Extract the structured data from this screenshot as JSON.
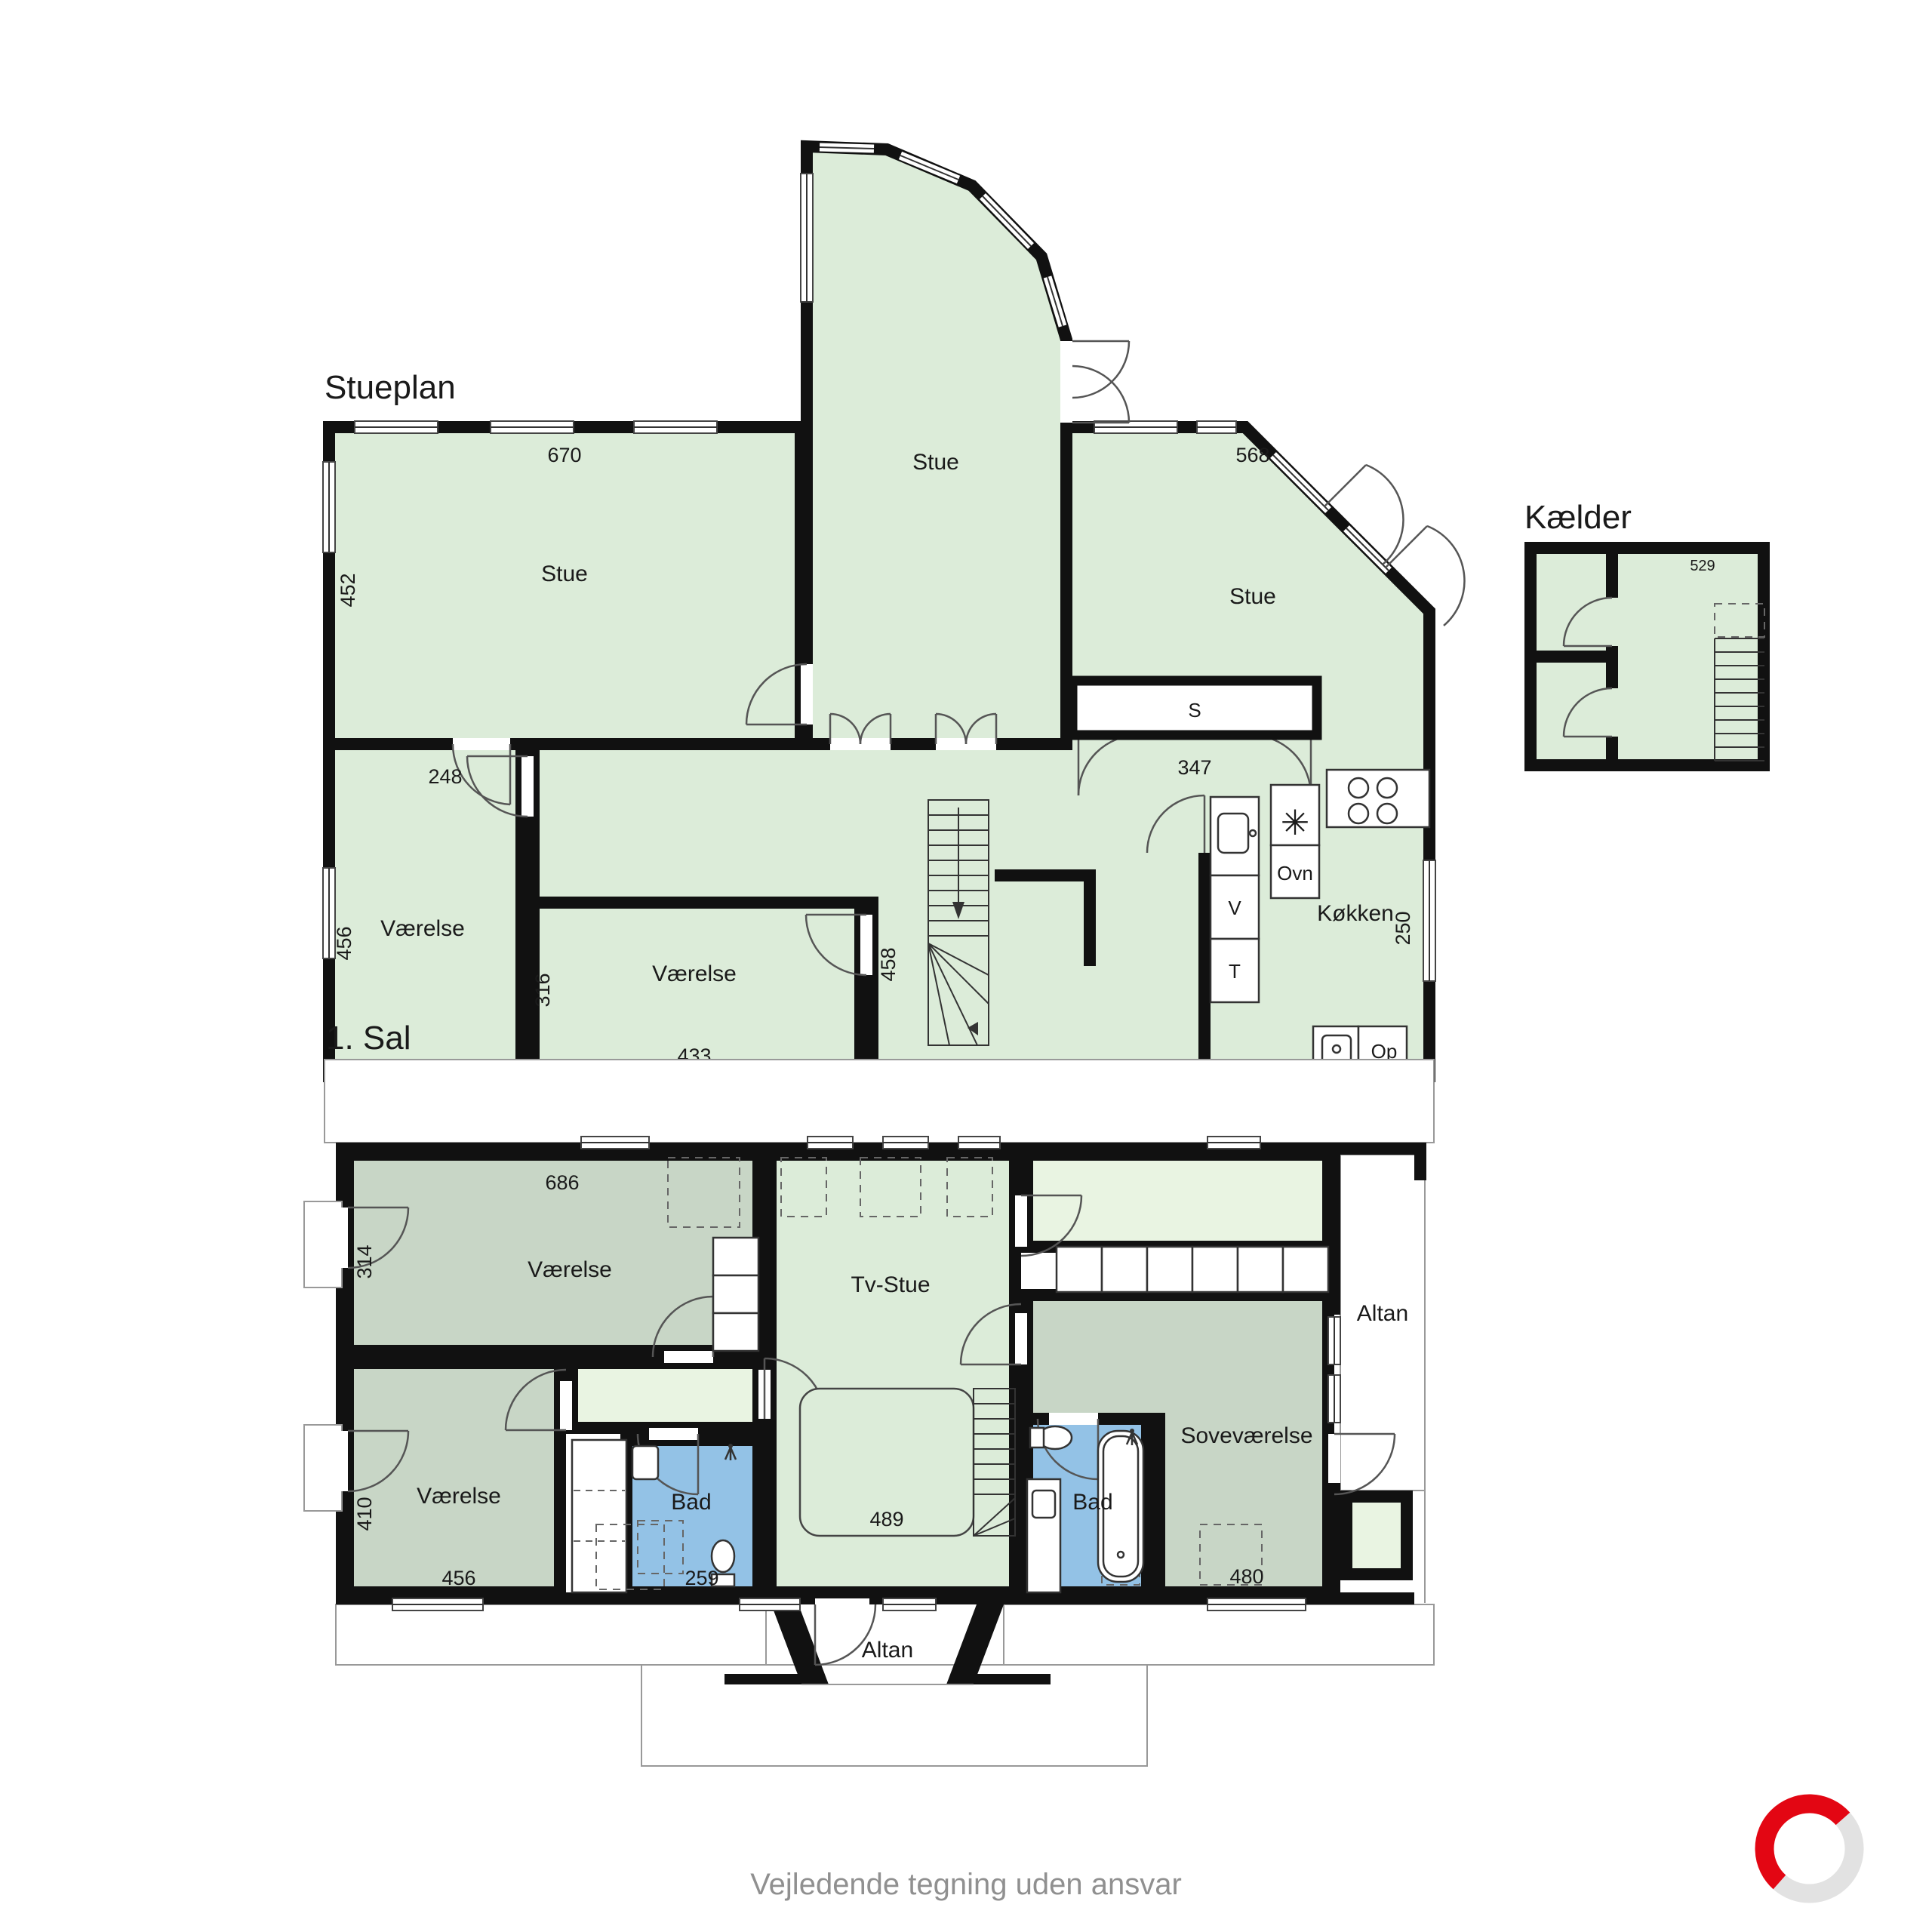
{
  "document": {
    "footer": "Vejledende tegning uden ansvar"
  },
  "colors": {
    "wall": "#111111",
    "room_light_green": "#dcecd9",
    "room_sage_green": "#c8d6c6",
    "room_pale_green": "#e9f4e2",
    "wet_room_blue": "#93c2e6",
    "roof_line_gray": "#999999",
    "footer_text_gray": "#909090",
    "logo_red": "#e30613",
    "logo_light_gray": "#e2e2e2"
  },
  "stueplan": {
    "title": "Stueplan",
    "room_stue": "Stue",
    "room_vaerelse": "Værelse",
    "room_wc": "Wc",
    "room_koekken": "Køkken",
    "unit_ovn": "Ovn",
    "unit_v": "V",
    "unit_t": "T",
    "unit_s": "S",
    "unit_op": "Op",
    "cooktop_symbol": "✳",
    "dim_670": "670",
    "dim_452": "452",
    "dim_568": "568",
    "dim_248": "248",
    "dim_456": "456",
    "dim_316": "316",
    "dim_433": "433",
    "dim_458": "458",
    "dim_347": "347",
    "dim_250": "250"
  },
  "kaelder": {
    "title": "Kælder",
    "dim_529": "529"
  },
  "sal": {
    "title": "1. Sal",
    "room_vaerelse": "Værelse",
    "room_tv_stue": "Tv-Stue",
    "room_bad": "Bad",
    "room_sovevaerelse": "Soveværelse",
    "room_altan": "Altan",
    "dim_686": "686",
    "dim_314": "314",
    "dim_410": "410",
    "dim_456": "456",
    "dim_259": "259",
    "dim_489": "489",
    "dim_480": "480"
  }
}
